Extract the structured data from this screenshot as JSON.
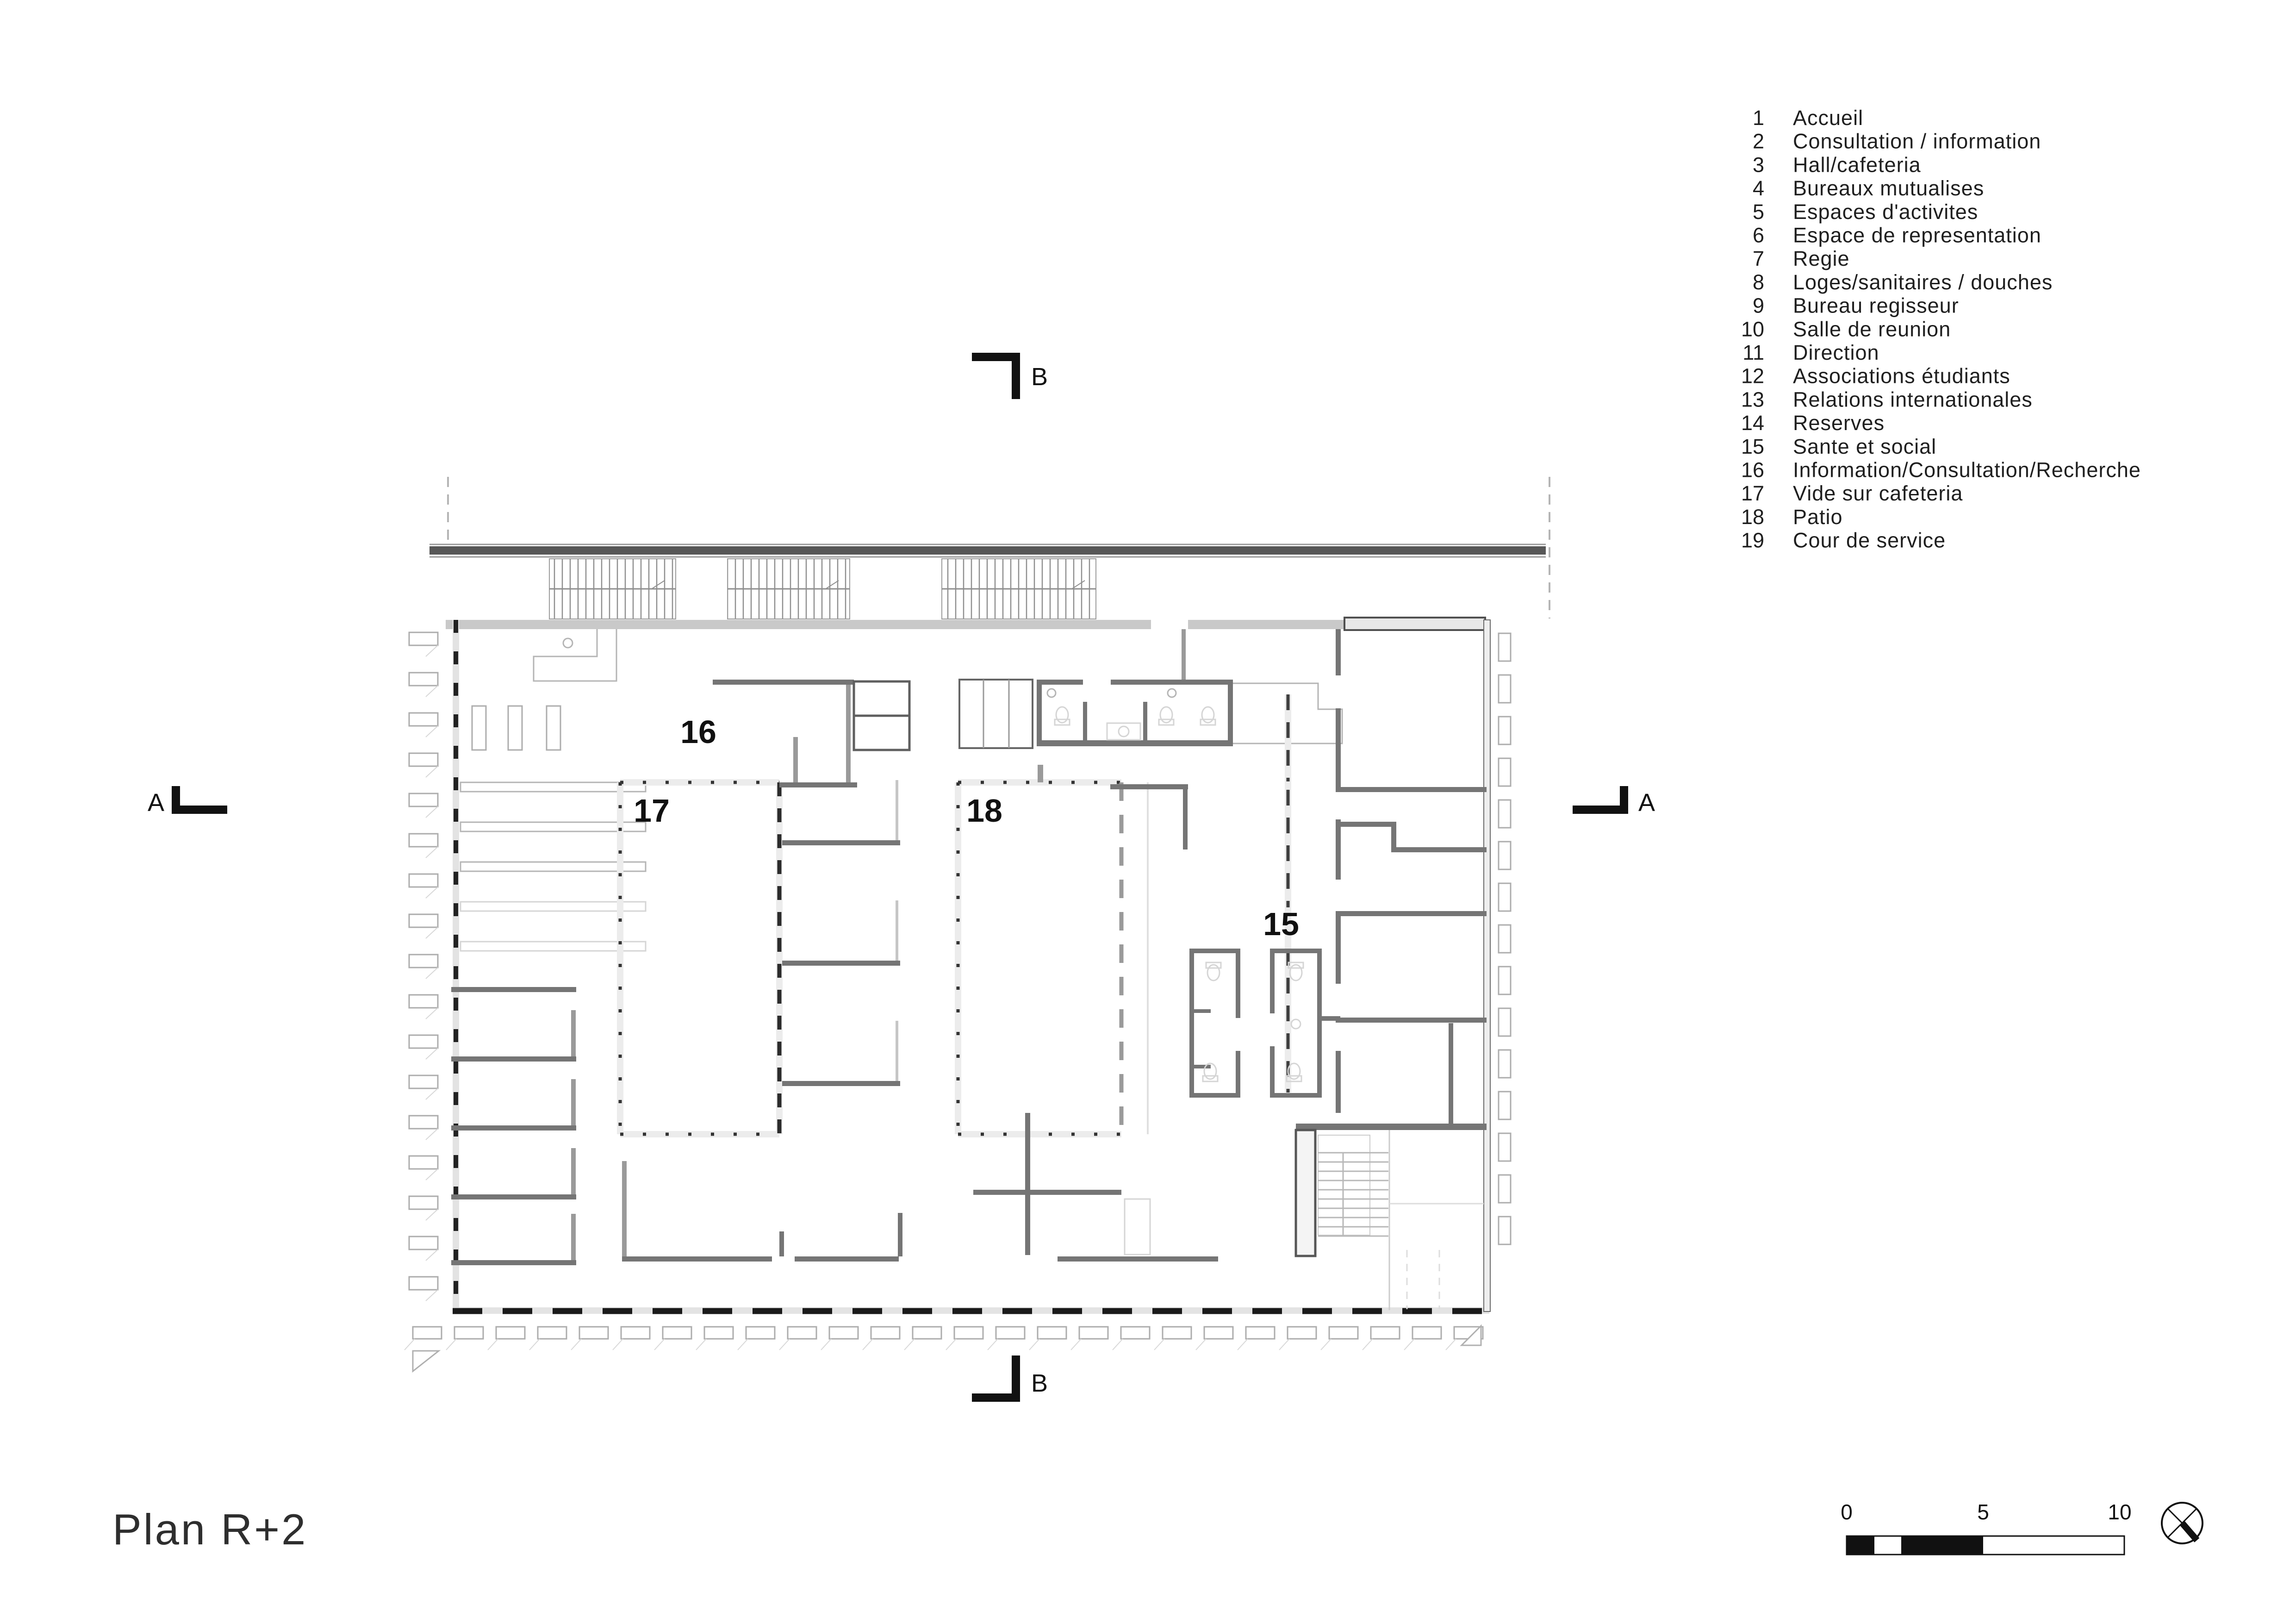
{
  "page_title": "Plan R+2",
  "legend": {
    "items": [
      {
        "num": "1",
        "label": "Accueil"
      },
      {
        "num": "2",
        "label": "Consultation / information"
      },
      {
        "num": "3",
        "label": "Hall/cafeteria"
      },
      {
        "num": "4",
        "label": "Bureaux mutualises"
      },
      {
        "num": "5",
        "label": "Espaces d'activites"
      },
      {
        "num": "6",
        "label": "Espace de representation"
      },
      {
        "num": "7",
        "label": "Regie"
      },
      {
        "num": "8",
        "label": "Loges/sanitaires / douches"
      },
      {
        "num": "9",
        "label": "Bureau regisseur"
      },
      {
        "num": "10",
        "label": "Salle de reunion"
      },
      {
        "num": "11",
        "label": "Direction"
      },
      {
        "num": "12",
        "label": "Associations étudiants"
      },
      {
        "num": "13",
        "label": "Relations internationales"
      },
      {
        "num": "14",
        "label": "Reserves"
      },
      {
        "num": "15",
        "label": "Sante et social"
      },
      {
        "num": "16",
        "label": "Information/Consultation/Recherche"
      },
      {
        "num": "17",
        "label": "Vide sur cafeteria"
      },
      {
        "num": "18",
        "label": "Patio"
      },
      {
        "num": "19",
        "label": "Cour de service"
      }
    ]
  },
  "plan": {
    "room_labels": [
      "16",
      "17",
      "18",
      "15"
    ],
    "section_letters": {
      "left": "A",
      "right": "A",
      "top": "B",
      "bottom": "B"
    }
  },
  "scale_bar": {
    "ticks": [
      "0",
      "5",
      "10"
    ]
  },
  "icons": {
    "north_indicator": "crossed-circle-north-symbol"
  },
  "colors": {
    "wall_dark": "#757575",
    "wall_gray": "#c9c9c9",
    "canopy": "#575757",
    "text": "#1f1f1f"
  }
}
